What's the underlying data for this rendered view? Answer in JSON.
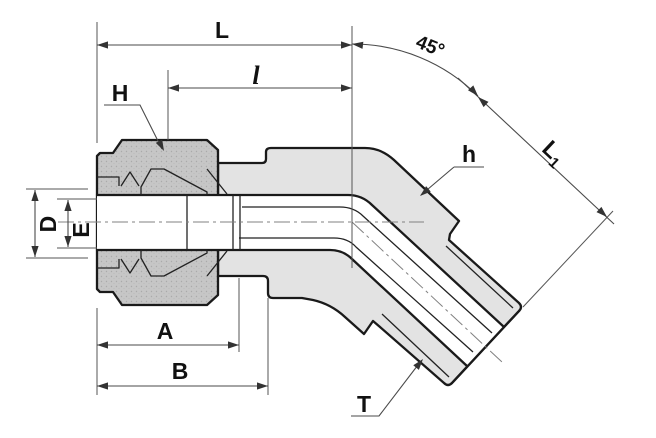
{
  "drawing": {
    "kind": "45-degree male elbow tube fitting cross-section",
    "dimension_labels": {
      "overall_length": "L",
      "body_length": "l",
      "angle": "45°",
      "nut_hex": "H",
      "body_hex": "h",
      "l1_main": "L",
      "l1_sub": "1",
      "outer_diameter": "D",
      "inner_diameter": "E",
      "dim_a": "A",
      "dim_b": "B",
      "thread": "T"
    },
    "colors": {
      "background": "#ffffff",
      "body_fill": "#e3e3e3",
      "nut_fill": "#c6c6c6",
      "bore_fill": "#ffffff",
      "ferrule_fill": "#fafafa",
      "outline": "#1a1a1a",
      "dimension_lines": "#4a4a4a"
    }
  }
}
